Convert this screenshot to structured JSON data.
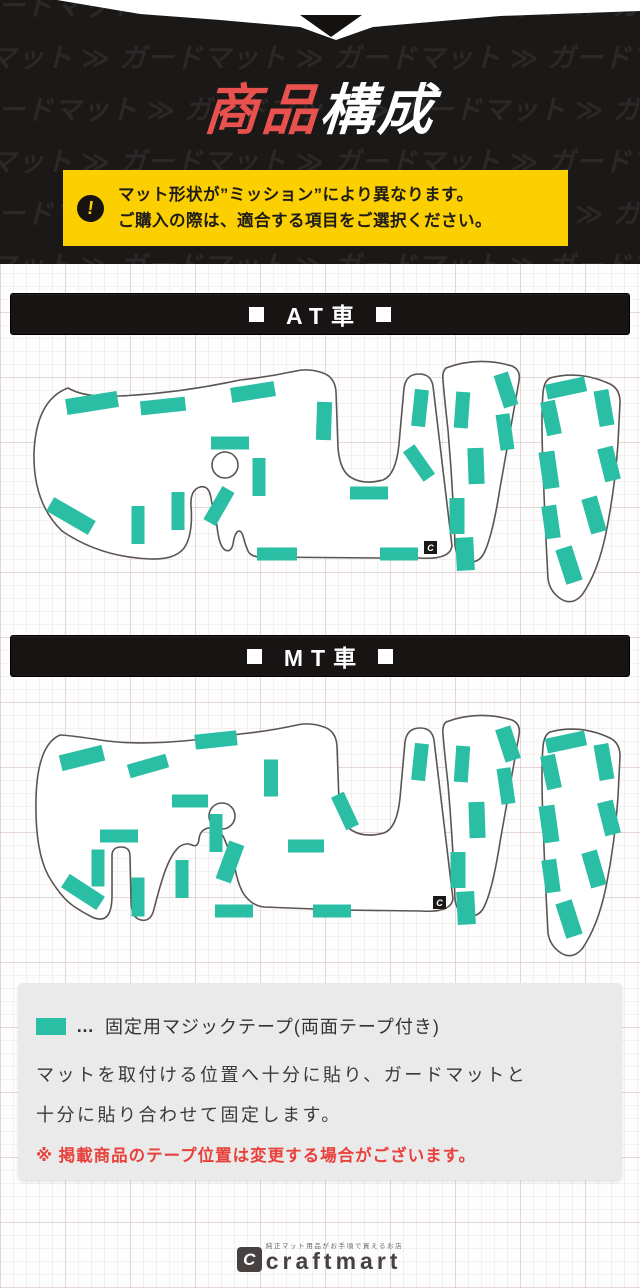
{
  "colors": {
    "dark_bg": "#1b1918",
    "pattern_text": "#2b2827",
    "title_red": "#e8514e",
    "title_white": "#ffffff",
    "notice_bg": "#fccf00",
    "tape_teal": "#2abfa4",
    "outline": "#5b5552",
    "mat_fill": "#ffffff",
    "note_red": "#e8413c",
    "bar_bg": "#171413",
    "brand_gray": "#474141"
  },
  "header": {
    "watermark_word": "ガードマット",
    "watermark_separator": "≫",
    "title": {
      "part1": "商品",
      "part2": "構成"
    },
    "notice": {
      "icon": "!",
      "line1": "マット形状が”ミッション”により異なります。",
      "line2": "ご購入の際は、適合する項目をご選択ください。"
    }
  },
  "sections": {
    "at": {
      "marker": "■",
      "label": "AT車"
    },
    "mt": {
      "marker": "■",
      "label": "MT車"
    }
  },
  "legend": {
    "dots": "…",
    "line1": "固定用マジックテープ(両面テープ付き)",
    "body_line1": "マットを取付ける位置へ十分に貼り、ガードマットと",
    "body_line2": "十分に貼り合わせて固定します。",
    "note": "※ 掲載商品のテープ位置は変更する場合がございます。"
  },
  "footer": {
    "mark": "C",
    "tagline": "純正マット用品がお手頃で買えるお店",
    "brand": "craftmart"
  },
  "diagram": {
    "mark_glyph": "C",
    "at": {
      "outlines": [
        "M 68,40 Q 36,52 34,105 Q 33,155 62,183 Q 100,209 150,211 Q 178,212 186,197 Q 193,183 191,158 Q 190,142 200,139 Q 209,137 211,150 Q 213,162 217,178 Q 219,198 225,202 Q 231,205 233,196 Q 234,188 237,184 Q 241,181 243,188 Q 245,196 248,203 Q 251,209 261,209 L 380,210 L 420,210 Q 450,212 452,198 L 433,38 Q 431,26 419,26 Q 406,26 404,40 L 399,96 Q 396,127 383,132 Q 364,137 352,130 Q 340,124 338,100 L 336,44 Q 335,29 323,25 Q 309,20 296,23 Q 268,29 240,32 Q 180,45 120,48 Q 85,50 68,40 Z",
        "M 446,20 Q 478,8 512,18 Q 521,22 519,33 L 500,140 Q 493,185 485,203 Q 479,217 466,213 Q 456,209 455,197 Q 453,140 448,82 Q 444,46 443,32 Q 442,24 446,20 Z",
        "M 550,30 Q 580,22 610,36 Q 620,41 620,54 L 618,95 Q 615,140 606,185 Q 598,224 582,247 Q 572,258 561,251 Q 550,244 548,231 Q 545,175 543,120 Q 541,68 543,45 Q 544,33 550,30 Z"
      ],
      "hole": {
        "cx": 225,
        "cy": 117,
        "r": 13
      },
      "icon": {
        "x": 424,
        "y": 193
      },
      "tapes": [
        [
          92,
          55,
          52,
          16,
          -9
        ],
        [
          163,
          58,
          45,
          14,
          -6
        ],
        [
          253,
          44,
          44,
          15,
          -9
        ],
        [
          324,
          73,
          15,
          38,
          2
        ],
        [
          230,
          95,
          38,
          13,
          0
        ],
        [
          259,
          129,
          13,
          38,
          0
        ],
        [
          219,
          158,
          14,
          38,
          30
        ],
        [
          178,
          163,
          13,
          38,
          0
        ],
        [
          138,
          177,
          13,
          38,
          0
        ],
        [
          71,
          168,
          48,
          16,
          30
        ],
        [
          277,
          206,
          40,
          13,
          0
        ],
        [
          399,
          206,
          38,
          13,
          0
        ],
        [
          369,
          145,
          38,
          13,
          0
        ],
        [
          419,
          115,
          14,
          36,
          -35
        ],
        [
          420,
          60,
          14,
          37,
          6
        ],
        [
          506,
          42,
          15,
          34,
          -18
        ],
        [
          462,
          62,
          14,
          36,
          4
        ],
        [
          505,
          84,
          14,
          36,
          -8
        ],
        [
          476,
          118,
          16,
          36,
          -2
        ],
        [
          457,
          168,
          15,
          36,
          0
        ],
        [
          465,
          206,
          18,
          33,
          -3
        ],
        [
          566,
          40,
          40,
          15,
          -12
        ],
        [
          604,
          60,
          15,
          36,
          -10
        ],
        [
          551,
          70,
          15,
          34,
          -12
        ],
        [
          609,
          116,
          16,
          34,
          -14
        ],
        [
          549,
          122,
          16,
          37,
          -8
        ],
        [
          594,
          167,
          16,
          36,
          -16
        ],
        [
          551,
          174,
          15,
          33,
          -8
        ],
        [
          569,
          217,
          17,
          36,
          -18
        ]
      ]
    },
    "mt": {
      "outlines": [
        "M 60,35 Q 37,45 36,100 Q 35,150 48,175 Q 60,196 72,205 Q 82,212 92,217 Q 103,222 108,215 Q 112,209 112,195 L 112,156 Q 112,147 121,147 Q 130,147 130,156 L 131,200 Q 131,218 141,220 Q 151,222 154,209 Q 159,189 164,174 Q 171,154 179,147 Q 186,142 192,145 Q 198,148 199,139 Q 200,130 208,128 Q 218,126 224,138 Q 230,152 235,168 Q 239,190 247,198 Q 254,206 264,207 L 340,210 L 421,211 Q 451,213 453,199 L 434,40 Q 432,28 420,28 Q 407,28 405,42 L 400,98 Q 397,128 384,133 Q 365,138 353,131 Q 341,125 339,102 L 337,46 Q 336,31 324,27 Q 310,22 297,25 Q 270,31 240,34 Q 150,48 100,40 Q 75,36 60,35 Z",
        "M 446,22 Q 478,10 512,20 Q 521,24 519,35 L 500,142 Q 493,187 485,205 Q 479,219 466,215 Q 456,211 455,199 Q 453,142 448,84 Q 444,48 443,34 Q 442,26 446,22 Z",
        "M 550,32 Q 580,24 610,38 Q 620,43 620,56 L 618,97 Q 615,142 606,187 Q 598,226 582,249 Q 572,260 561,253 Q 550,246 548,233 Q 545,177 543,122 Q 541,70 543,47 Q 544,35 550,32 Z"
      ],
      "hole": {
        "cx": 222,
        "cy": 116,
        "r": 13
      },
      "icon": {
        "x": 433,
        "y": 196
      },
      "tapes": [
        [
          82,
          58,
          44,
          16,
          -14
        ],
        [
          148,
          66,
          40,
          14,
          -16
        ],
        [
          216,
          40,
          42,
          15,
          -6
        ],
        [
          271,
          78,
          14,
          37,
          0
        ],
        [
          190,
          101,
          36,
          13,
          0
        ],
        [
          216,
          133,
          13,
          38,
          0
        ],
        [
          230,
          162,
          16,
          40,
          20
        ],
        [
          182,
          179,
          13,
          38,
          0
        ],
        [
          98,
          168,
          13,
          37,
          0
        ],
        [
          138,
          197,
          13,
          39,
          0
        ],
        [
          83,
          192,
          42,
          16,
          33
        ],
        [
          119,
          136,
          38,
          13,
          0
        ],
        [
          234,
          211,
          38,
          13,
          0
        ],
        [
          332,
          211,
          38,
          13,
          0
        ],
        [
          306,
          146,
          36,
          13,
          0
        ],
        [
          345,
          111,
          14,
          36,
          -25
        ],
        [
          420,
          62,
          14,
          37,
          6
        ],
        [
          508,
          44,
          16,
          34,
          -18
        ],
        [
          462,
          64,
          14,
          36,
          4
        ],
        [
          506,
          86,
          14,
          36,
          -8
        ],
        [
          477,
          120,
          16,
          36,
          -2
        ],
        [
          458,
          170,
          15,
          36,
          0
        ],
        [
          466,
          208,
          18,
          33,
          -3
        ],
        [
          566,
          42,
          40,
          15,
          -12
        ],
        [
          604,
          62,
          15,
          36,
          -10
        ],
        [
          551,
          72,
          15,
          34,
          -12
        ],
        [
          609,
          118,
          16,
          34,
          -14
        ],
        [
          549,
          124,
          16,
          37,
          -8
        ],
        [
          594,
          169,
          16,
          36,
          -16
        ],
        [
          551,
          176,
          15,
          33,
          -8
        ],
        [
          569,
          219,
          17,
          36,
          -18
        ]
      ]
    }
  }
}
